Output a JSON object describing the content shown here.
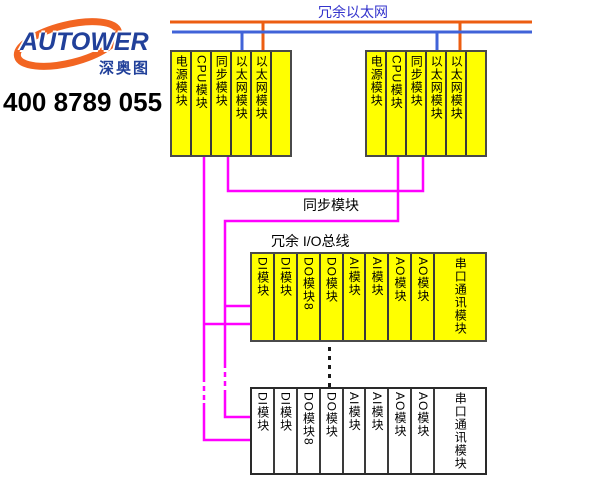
{
  "branding": {
    "logo_text": "AUTOWER",
    "logo_sub": "深奥图",
    "phone": "400 8789 055"
  },
  "labels": {
    "ethernet_bus": "冗余以太网",
    "sync_link": "同步模块",
    "io_bus": "冗余 I/O总线"
  },
  "controller_racks": [
    {
      "modules": [
        "电源模块",
        "CPU模块",
        "同步模块",
        "以太网模块",
        "以太网模块",
        ""
      ]
    },
    {
      "modules": [
        "电源模块",
        "CPU模块",
        "同步模块",
        "以太网模块",
        "以太网模块",
        ""
      ]
    }
  ],
  "io_racks": [
    {
      "style": "yellow",
      "modules": [
        "DI模块",
        "DI模块",
        "DO模块8",
        "DO模块",
        "AI模块",
        "AI模块",
        "AO模块",
        "AO模块",
        "串口通讯模块"
      ]
    },
    {
      "style": "white",
      "modules": [
        "DI模块",
        "DI模块",
        "DO模块8",
        "DO模块",
        "AI模块",
        "AI模块",
        "AO模块",
        "AO模块",
        "串口通讯模块"
      ]
    }
  ],
  "colors": {
    "module_yellow": "#ffff00",
    "bus_magenta": "#ff00ff",
    "ethernet_orange": "#ec5d11",
    "ethernet_blue": "#4063d8",
    "title_blue": "#3333cc",
    "logo_blue": "#21409a",
    "logo_orange": "#f26522"
  }
}
